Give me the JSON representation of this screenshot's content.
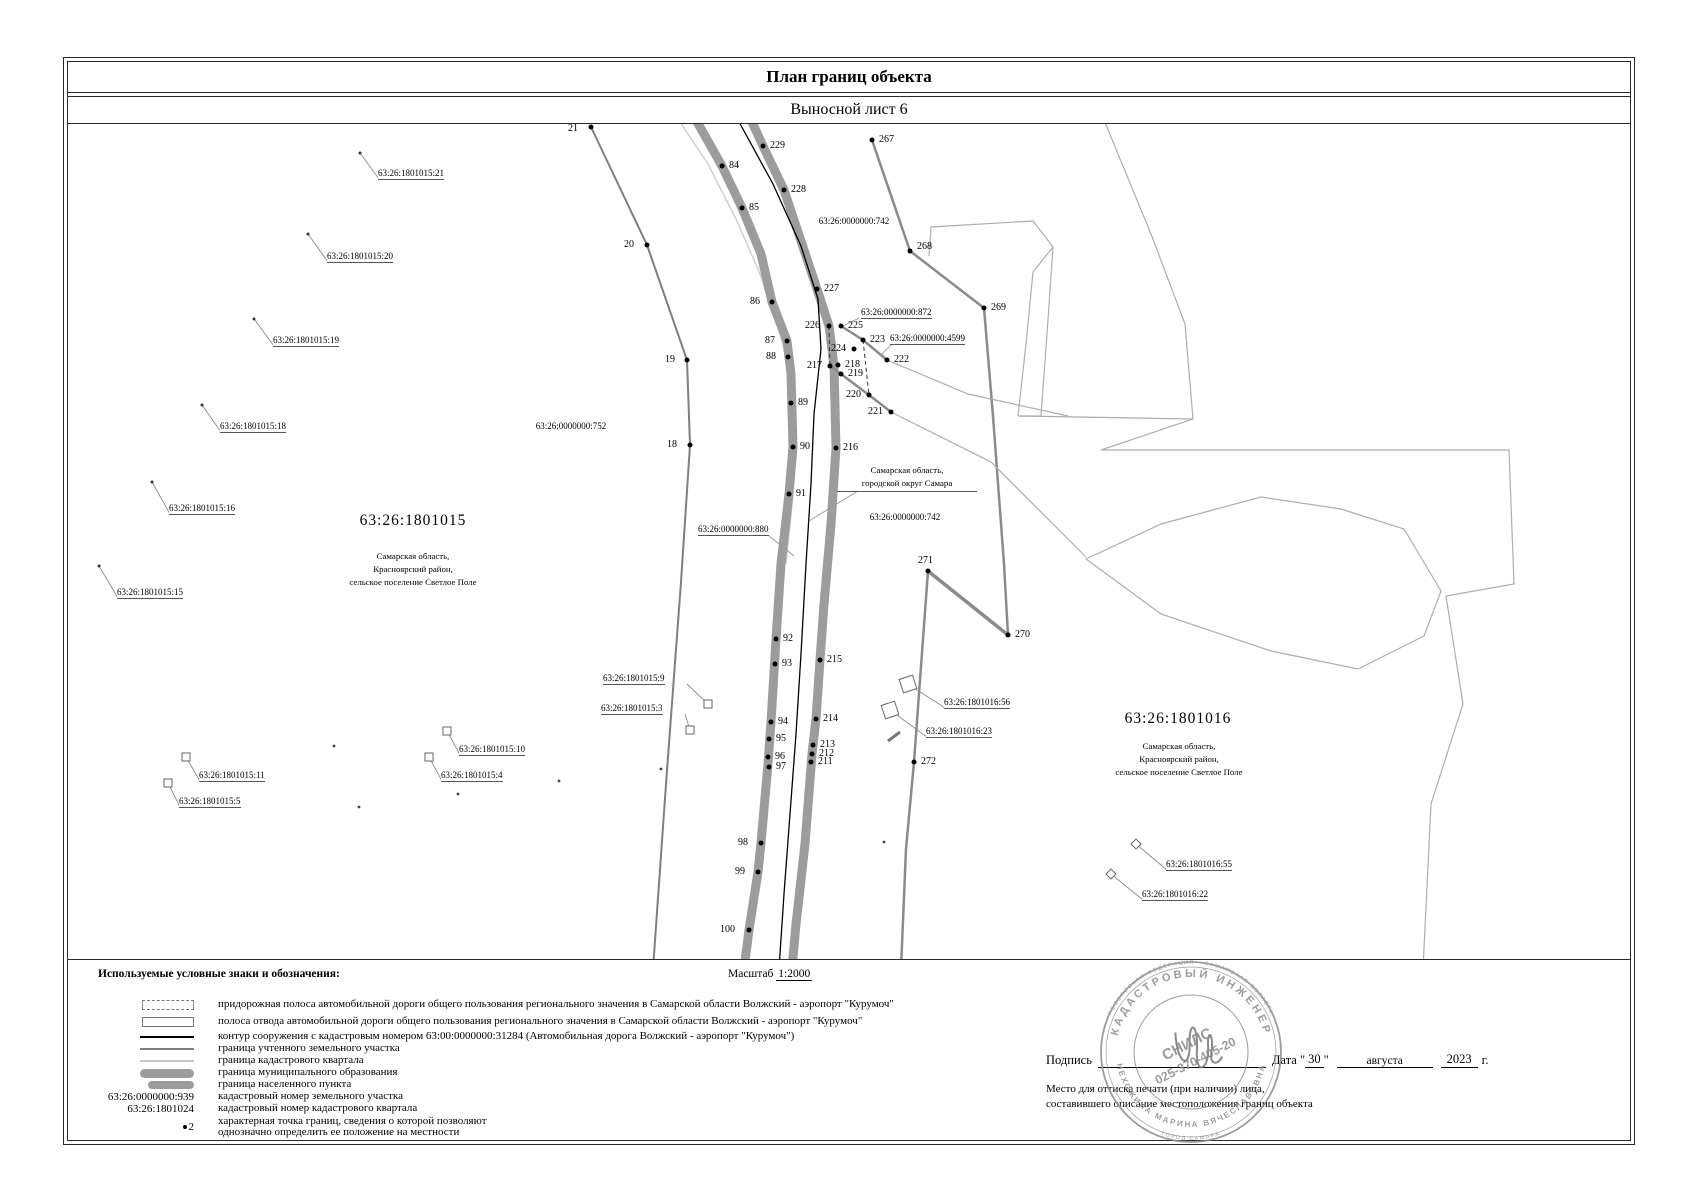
{
  "title": "План границ объекта",
  "subtitle": "Выносной лист 6",
  "legend": {
    "header": "Используемые условные знаки и обозначения:",
    "scale_label": "Масштаб",
    "scale_value": "1:2000",
    "items": [
      {
        "sym": "rect-dashed",
        "text": "придорожная полоса автомобильной дороги общего пользования регионального значения в Самарской области Волжский - аэропорт \"Курумоч\""
      },
      {
        "sym": "rect-solid",
        "text": "полоса отвода автомобильной дороги общего пользования регионального значения в Самарской области Волжский - аэропорт \"Курумоч\""
      },
      {
        "sym": "line-black",
        "text": "контур сооружения с кадастровым номером 63:00:0000000:31284  (Автомобильная дорога Волжский - аэропорт \"Курумоч\")"
      },
      {
        "sym": "line-gray",
        "text": "граница учтенного земельного участка"
      },
      {
        "sym": "line-light",
        "text": "граница кадастрового квартала"
      },
      {
        "sym": "band-wide",
        "text": "граница муниципального образования"
      },
      {
        "sym": "band-narrow",
        "text": "граница населенного пункта"
      },
      {
        "sym": "text",
        "symtext": "63:26:0000000:939",
        "text": "кадастровый номер земельного участка"
      },
      {
        "sym": "text",
        "symtext": "63:26:1801024",
        "text": "кадастровый номер кадастрового квартала"
      },
      {
        "sym": "point",
        "symtext": "2",
        "text": "характерная точка границ, сведения о которой позволяют\nоднозначно определить ее положение на местности"
      }
    ]
  },
  "footer": {
    "signature_label": "Подпись",
    "date_label": "Дата",
    "date_day": "30",
    "date_month": "августа",
    "date_year": "2023",
    "date_suffix": "г.",
    "stamp_note_line1": "Место для оттиска печати (при наличии) лица,",
    "stamp_note_line2": "составившего описание местоположения границ объекта",
    "stamp": {
      "ring_top": "КАДАСТРОВЫЙ ИНЖЕНЕР",
      "ring_bottom": "НЕХОЖИНА МАРИНА ВЯЧЕСЛАВОВНА",
      "outer_top": "РОССИЙСКАЯ ФЕДЕРАЦИЯ · САМАРСКАЯ ОБЛАСТЬ",
      "outer_bottom": "ГОРОД САМАРА",
      "center_line1": "СНИЛС",
      "center_line2": "025-370-405-20"
    }
  },
  "colors": {
    "boundary_band": "#9c9c9c",
    "contour_line": "#000000",
    "parcel_line": "#7f7f7f",
    "quartal_line": "#c6c6c6"
  },
  "map": {
    "points": [
      {
        "n": "21",
        "x": 523,
        "y": 3,
        "lx": 500,
        "ly": 0
      },
      {
        "n": "20",
        "x": 579,
        "y": 121,
        "lx": 556,
        "ly": 116
      },
      {
        "n": "19",
        "x": 619,
        "y": 236,
        "lx": 597,
        "ly": 231
      },
      {
        "n": "18",
        "x": 622,
        "y": 321,
        "lx": 599,
        "ly": 316
      },
      {
        "n": "84",
        "x": 654,
        "y": 42,
        "lx": 661,
        "ly": 37
      },
      {
        "n": "85",
        "x": 674,
        "y": 84,
        "lx": 681,
        "ly": 79
      },
      {
        "n": "86",
        "x": 704,
        "y": 178,
        "lx": 682,
        "ly": 173
      },
      {
        "n": "87",
        "x": 719,
        "y": 217,
        "lx": 697,
        "ly": 212
      },
      {
        "n": "88",
        "x": 720,
        "y": 233,
        "lx": 698,
        "ly": 228
      },
      {
        "n": "89",
        "x": 723,
        "y": 279,
        "lx": 730,
        "ly": 274
      },
      {
        "n": "90",
        "x": 725,
        "y": 323,
        "lx": 732,
        "ly": 318
      },
      {
        "n": "91",
        "x": 721,
        "y": 370,
        "lx": 728,
        "ly": 365
      },
      {
        "n": "92",
        "x": 708,
        "y": 515,
        "lx": 715,
        "ly": 510
      },
      {
        "n": "93",
        "x": 707,
        "y": 540,
        "lx": 714,
        "ly": 535
      },
      {
        "n": "94",
        "x": 703,
        "y": 598,
        "lx": 710,
        "ly": 593
      },
      {
        "n": "95",
        "x": 701,
        "y": 615,
        "lx": 708,
        "ly": 610
      },
      {
        "n": "96",
        "x": 700,
        "y": 633,
        "lx": 707,
        "ly": 628
      },
      {
        "n": "97",
        "x": 701,
        "y": 643,
        "lx": 708,
        "ly": 638
      },
      {
        "n": "98",
        "x": 693,
        "y": 719,
        "lx": 670,
        "ly": 714
      },
      {
        "n": "99",
        "x": 690,
        "y": 748,
        "lx": 667,
        "ly": 743
      },
      {
        "n": "100",
        "x": 681,
        "y": 806,
        "lx": 652,
        "ly": 801
      },
      {
        "n": "229",
        "x": 695,
        "y": 22,
        "lx": 702,
        "ly": 17
      },
      {
        "n": "228",
        "x": 716,
        "y": 66,
        "lx": 723,
        "ly": 61
      },
      {
        "n": "227",
        "x": 749,
        "y": 165,
        "lx": 756,
        "ly": 160
      },
      {
        "n": "226",
        "x": 761,
        "y": 202,
        "lx": 737,
        "ly": 197
      },
      {
        "n": "225",
        "x": 773,
        "y": 202,
        "lx": 780,
        "ly": 197
      },
      {
        "n": "224",
        "x": 786,
        "y": 225,
        "lx": 763,
        "ly": 220
      },
      {
        "n": "223",
        "x": 795,
        "y": 216,
        "lx": 802,
        "ly": 211
      },
      {
        "n": "222",
        "x": 819,
        "y": 236,
        "lx": 826,
        "ly": 231
      },
      {
        "n": "217",
        "x": 762,
        "y": 242,
        "lx": 739,
        "ly": 237
      },
      {
        "n": "218",
        "x": 770,
        "y": 241,
        "lx": 777,
        "ly": 236
      },
      {
        "n": "219",
        "x": 773,
        "y": 250,
        "lx": 780,
        "ly": 245
      },
      {
        "n": "220",
        "x": 801,
        "y": 271,
        "lx": 778,
        "ly": 266
      },
      {
        "n": "221",
        "x": 823,
        "y": 288,
        "lx": 800,
        "ly": 283
      },
      {
        "n": "216",
        "x": 768,
        "y": 324,
        "lx": 775,
        "ly": 319
      },
      {
        "n": "215",
        "x": 752,
        "y": 536,
        "lx": 759,
        "ly": 531
      },
      {
        "n": "214",
        "x": 748,
        "y": 595,
        "lx": 755,
        "ly": 590
      },
      {
        "n": "213",
        "x": 745,
        "y": 621,
        "lx": 752,
        "ly": 616
      },
      {
        "n": "212",
        "x": 744,
        "y": 630,
        "lx": 751,
        "ly": 625
      },
      {
        "n": "211",
        "x": 743,
        "y": 638,
        "lx": 750,
        "ly": 633
      },
      {
        "n": "267",
        "x": 804,
        "y": 16,
        "lx": 811,
        "ly": 11
      },
      {
        "n": "268",
        "x": 842,
        "y": 127,
        "lx": 849,
        "ly": 118
      },
      {
        "n": "269",
        "x": 916,
        "y": 184,
        "lx": 923,
        "ly": 179
      },
      {
        "n": "270",
        "x": 940,
        "y": 511,
        "lx": 947,
        "ly": 506
      },
      {
        "n": "271",
        "x": 860,
        "y": 447,
        "lx": 850,
        "ly": 432
      },
      {
        "n": "272",
        "x": 846,
        "y": 638,
        "lx": 853,
        "ly": 633
      }
    ],
    "plots": [
      {
        "text": "63:26:1801015:21",
        "tx": 310,
        "ty": 44,
        "m": "dot",
        "mx": 292,
        "my": 29
      },
      {
        "text": "63:26:1801015:20",
        "tx": 259,
        "ty": 127,
        "m": "dot",
        "mx": 240,
        "my": 110
      },
      {
        "text": "63:26:1801015:19",
        "tx": 205,
        "ty": 211,
        "m": "dot",
        "mx": 186,
        "my": 195
      },
      {
        "text": "63:26:1801015:18",
        "tx": 152,
        "ty": 297,
        "m": "dot",
        "mx": 134,
        "my": 281
      },
      {
        "text": "63:26:1801015:16",
        "tx": 101,
        "ty": 379,
        "m": "dot",
        "mx": 84,
        "my": 358
      },
      {
        "text": "63:26:1801015:15",
        "tx": 49,
        "ty": 463,
        "m": "dot",
        "mx": 31,
        "my": 442
      },
      {
        "text": "63:26:1801015:9",
        "tx": 535,
        "ty": 549,
        "m": "sq",
        "mx": 640,
        "my": 580
      },
      {
        "text": "63:26:1801015:3",
        "tx": 533,
        "ty": 579,
        "m": "sq",
        "mx": 622,
        "my": 606
      },
      {
        "text": "63:26:1801015:11",
        "tx": 131,
        "ty": 646,
        "m": "sq",
        "mx": 118,
        "my": 633
      },
      {
        "text": "63:26:1801015:5",
        "tx": 111,
        "ty": 672,
        "m": "sq",
        "mx": 100,
        "my": 659
      },
      {
        "text": "63:26:1801015:10",
        "tx": 391,
        "ty": 620,
        "m": "sq",
        "mx": 379,
        "my": 607
      },
      {
        "text": "63:26:1801015:4",
        "tx": 373,
        "ty": 646,
        "m": "sq",
        "mx": 361,
        "my": 633
      },
      {
        "text": "63:26:1801016:56",
        "tx": 876,
        "ty": 573,
        "m": "sqr",
        "mx": 840,
        "my": 560
      },
      {
        "text": "63:26:1801016:23",
        "tx": 858,
        "ty": 602,
        "m": "sqr",
        "mx": 822,
        "my": 586
      },
      {
        "text": "63:26:1801016:55",
        "tx": 1098,
        "ty": 735,
        "m": "dia",
        "mx": 1068,
        "my": 720
      },
      {
        "text": "63:26:1801016:22",
        "tx": 1074,
        "ty": 765,
        "m": "dia",
        "mx": 1043,
        "my": 750
      }
    ],
    "areas": [
      {
        "cls": "quarter",
        "text": "63:26:1801015",
        "x": 280,
        "y": 388,
        "w": 130
      },
      {
        "cls": "quarter",
        "text": "63:26:1801016",
        "x": 1045,
        "y": 586,
        "w": 130
      },
      {
        "cls": "addr",
        "text": "Самарская область,\nКрасноярский район,\nсельское поселение Светлое Поле",
        "x": 270,
        "y": 426,
        "w": 150
      },
      {
        "cls": "addr",
        "text": "Самарская область,\nКрасноярский район,\nсельское поселение Светлое Поле",
        "x": 1036,
        "y": 616,
        "w": 150
      },
      {
        "cls": "addr-u",
        "text": "Самарская область,\nгородской округ Самара",
        "x": 769,
        "y": 340,
        "w": 140
      },
      {
        "cls": "kn",
        "text": "63:26:0000000:742",
        "x": 726,
        "y": 92,
        "w": 120
      },
      {
        "cls": "kn",
        "text": "63:26:0000000:742",
        "x": 777,
        "y": 388,
        "w": 120
      },
      {
        "cls": "kn",
        "text": "63:26:0000000:752",
        "x": 443,
        "y": 297,
        "w": 120
      },
      {
        "cls": "kn-u",
        "text": "63:26:0000000:872",
        "x": 793,
        "y": 183
      },
      {
        "cls": "kn-u",
        "text": "63:26:0000000:4599",
        "x": 822,
        "y": 209
      },
      {
        "cls": "kn-u",
        "text": "63:26:0000000:880",
        "x": 630,
        "y": 400
      }
    ]
  }
}
